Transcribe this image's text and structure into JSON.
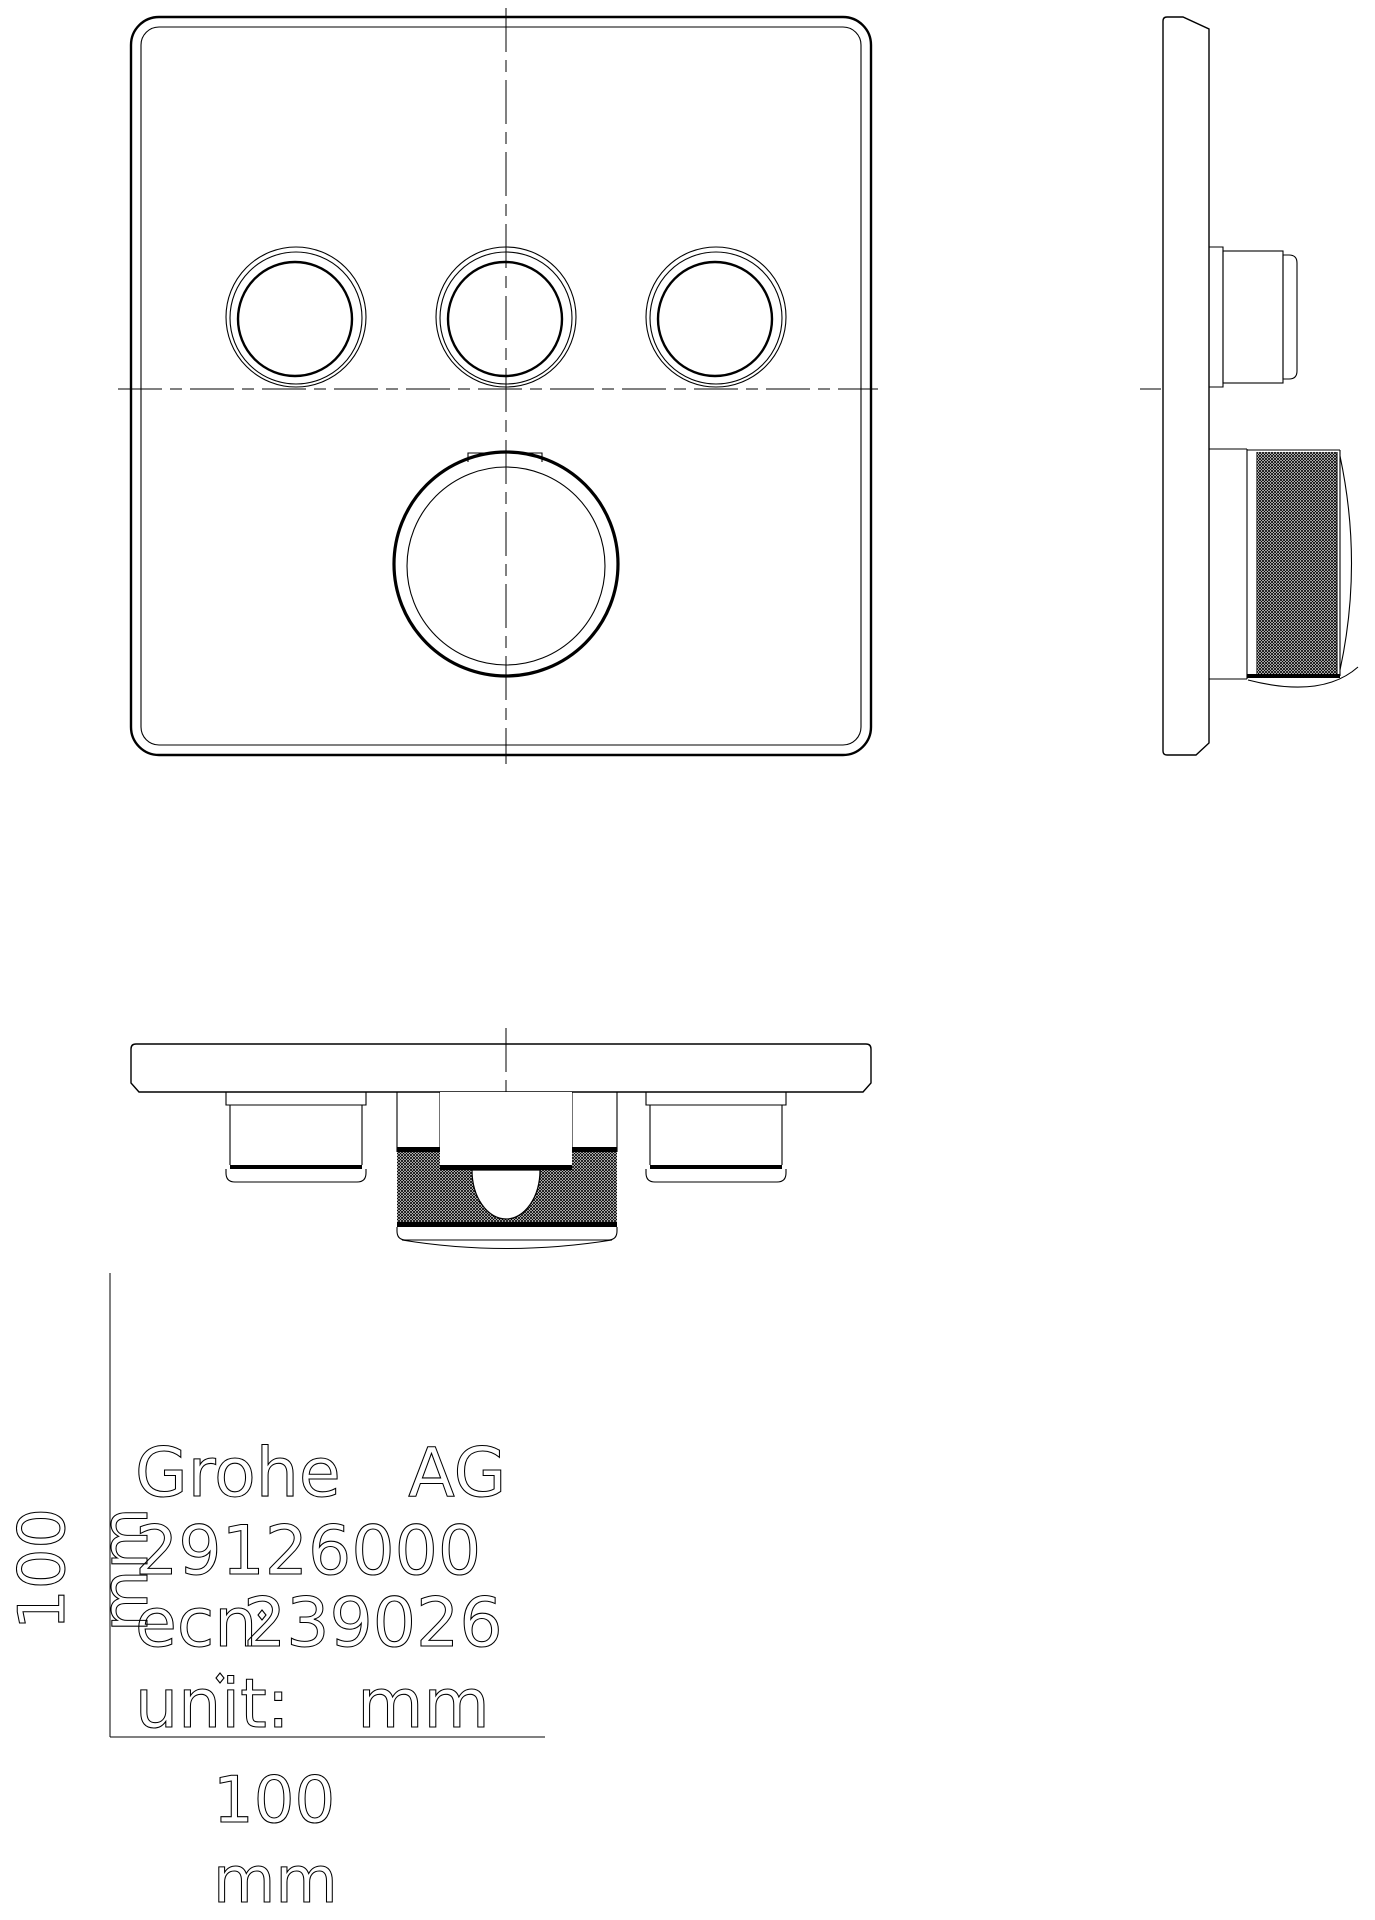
{
  "title_block": {
    "company": "Grohe AG",
    "product_number": "29126000",
    "ecn_label": "ecn",
    "ecn_number": "239026",
    "unit_label": "unit: mm"
  },
  "dimensions": {
    "height": {
      "value": "100",
      "unit": "mm"
    },
    "width": {
      "value": "100",
      "unit": "mm"
    }
  },
  "colors": {
    "line": "#000000",
    "background": "#ffffff",
    "fill_dark": "#000000",
    "fill_white": "#ffffff"
  }
}
